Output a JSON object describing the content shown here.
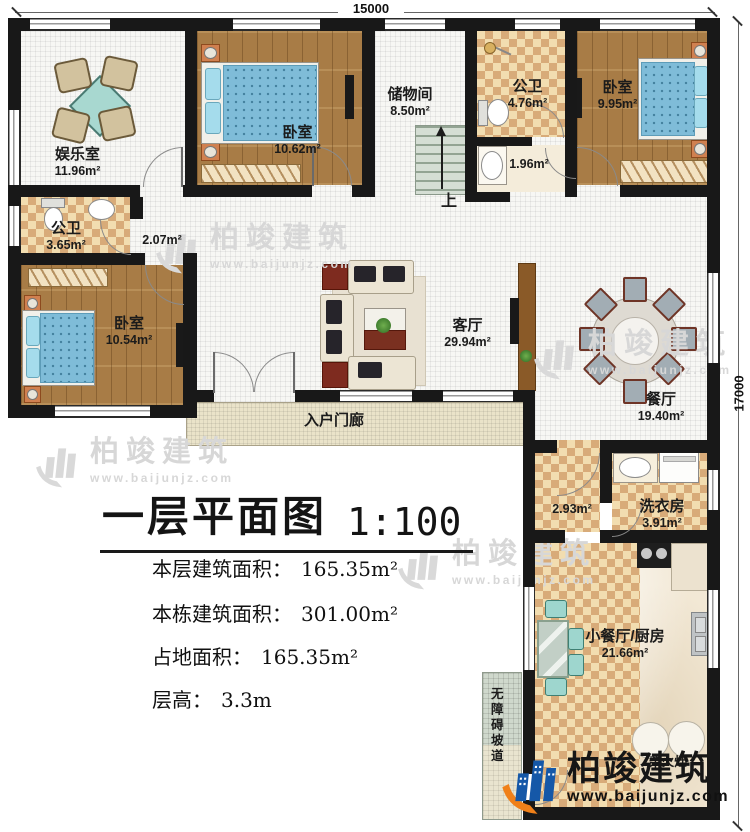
{
  "dimensions": {
    "width_label": "15000",
    "height_label": "17000"
  },
  "title_block": {
    "title": "一层平面图",
    "scale": "1:100",
    "stats": [
      {
        "label": "本层建筑面积：",
        "value": "165.35m²"
      },
      {
        "label": "本栋建筑面积：",
        "value": "301.00m²"
      },
      {
        "label": "占地面积：",
        "value": "165.35m²"
      },
      {
        "label": "层高：",
        "value": "3.3m"
      }
    ]
  },
  "rooms": {
    "entertainment": {
      "name": "娱乐室",
      "area": "11.96m²"
    },
    "bedroom_top_left": {
      "name": "卧室",
      "area": "10.62m²"
    },
    "storage": {
      "name": "储物间",
      "area": "8.50m²"
    },
    "bath_top": {
      "name": "公卫",
      "area": "4.76m²"
    },
    "bedroom_top_right": {
      "name": "卧室",
      "area": "9.95m²"
    },
    "bath_left": {
      "name": "公卫",
      "area": "3.65m²"
    },
    "hallway": {
      "area": "2.07m²"
    },
    "wash_area": {
      "area": "1.96m²"
    },
    "bedroom_left": {
      "name": "卧室",
      "area": "10.54m²"
    },
    "living": {
      "name": "客厅",
      "area": "29.94m²"
    },
    "dining": {
      "name": "餐厅",
      "area": "19.40m²"
    },
    "porch": {
      "name": "入户门廊"
    },
    "corridor": {
      "area": "2.93m²"
    },
    "laundry": {
      "name": "洗衣房",
      "area": "3.91m²"
    },
    "kitchen": {
      "name": "小餐厅/厨房",
      "area": "21.66m²"
    },
    "ramp": {
      "name": "无障碍坡道"
    },
    "wood_stove": {
      "name": "柴火灶"
    },
    "stairs": {
      "direction_label": "上"
    }
  },
  "watermark": {
    "brand": "柏竣建筑",
    "url": "www.baijunjz.com"
  },
  "logo": {
    "brand": "柏竣建筑",
    "url": "www.baijunjz.com"
  }
}
